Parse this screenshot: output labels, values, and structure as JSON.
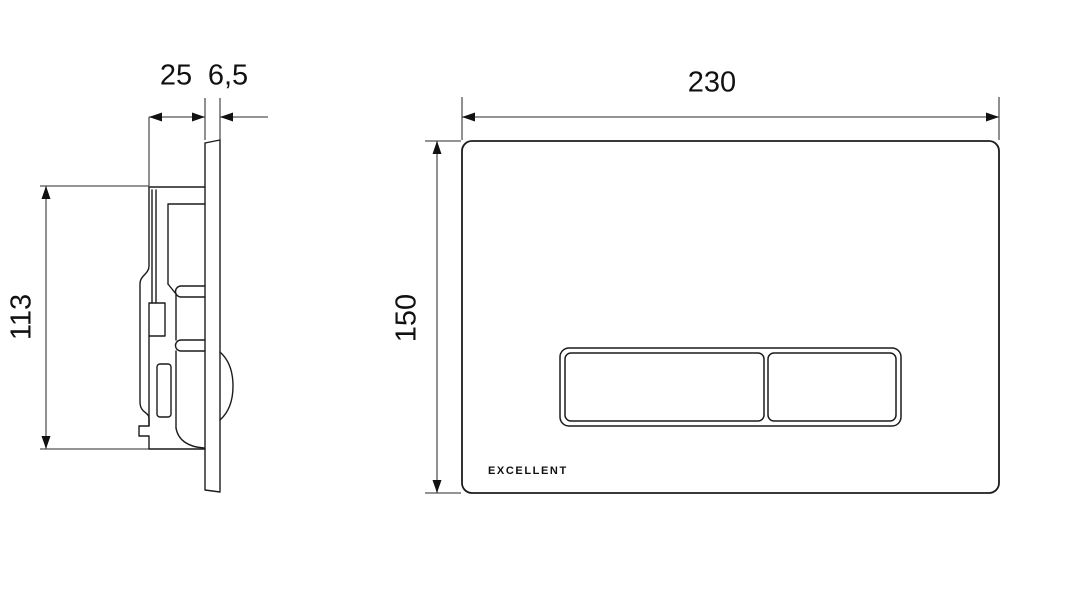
{
  "page": {
    "background": "#ffffff"
  },
  "drawing": {
    "colors": {
      "outline": "#1c1c1c",
      "dimension_line": "#555555",
      "arrow": "#111111",
      "fill": "#ffffff"
    },
    "side_view": {
      "depth_label": "25",
      "thickness_label": "6,5",
      "height_label": "113"
    },
    "front_view": {
      "width_label": "230",
      "height_label": "150",
      "brand": "EXCELLENT"
    }
  }
}
